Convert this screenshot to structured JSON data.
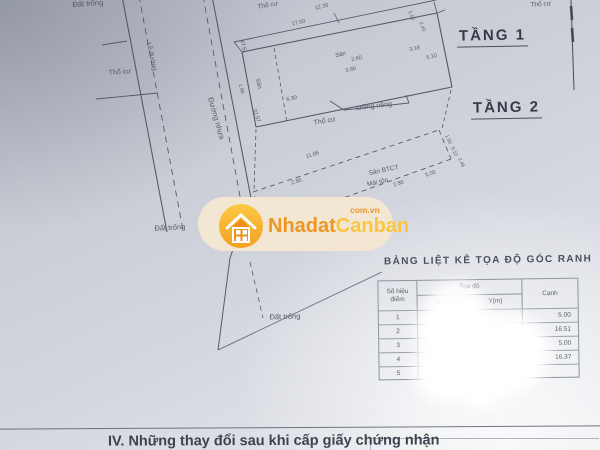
{
  "drawing": {
    "floor1": "TẦNG 1",
    "floor2": "TẦNG 2",
    "road": {
      "le_duong": "Lề đường",
      "duong_nhua": "Đường nhựa"
    },
    "labels": {
      "dat_trong": "Đất trống",
      "tho_cu": "Thổ cư",
      "san": "Sân",
      "san_btct": "Sân BTCT",
      "mai_ton": "Mái tôn",
      "tuong_rieng": "tường riêng"
    },
    "dims": {
      "d12_30": "12.30",
      "d17_50": "17.50",
      "d47_51": "47.51",
      "d1_98": "1.98",
      "d32_57": "32.57",
      "d6_30": "6.30",
      "d2_60": "2.60",
      "d3_90": "3.90",
      "d5_10": "5.10",
      "d3_18": "3.18",
      "d1_50": "1.50",
      "d2_40": "2.40",
      "d11_86": "11.86",
      "d2_86": "2.86",
      "d5_05": "5.05",
      "d2_46": "2.46"
    }
  },
  "watermark": {
    "brand_orange": "Nhadat",
    "brand_gold": "Canban",
    "domain": "com.vn",
    "colors": {
      "pill": "#f4e8d3",
      "circle_top": "#ffc93e",
      "circle_bottom": "#f5a01b",
      "text_orange": "#f0941f",
      "text_gold": "#fdc53d"
    }
  },
  "table": {
    "title": "BẢNG LIỆT KÊ TỌA ĐỘ GÓC RANH",
    "headers": {
      "point_l1": "Số hiệu",
      "point_l2": "điểm",
      "coord": "Tọa độ",
      "x": "X(m)",
      "y": "Y(m)",
      "edge": "Cạnh"
    },
    "rows": [
      {
        "n": "1",
        "x": "",
        "y": "",
        "edge": "5.00"
      },
      {
        "n": "2",
        "x": "",
        "y": "",
        "edge": "16.51"
      },
      {
        "n": "3",
        "x": "",
        "y": "",
        "edge": "5.00"
      },
      {
        "n": "4",
        "x": "",
        "y": "",
        "edge": "16.37"
      },
      {
        "n": "5",
        "x": "",
        "y": "",
        "edge": ""
      }
    ]
  },
  "footer": {
    "section_title": "IV. Những thay đổi sau khi cấp giấy chứng nhận"
  }
}
